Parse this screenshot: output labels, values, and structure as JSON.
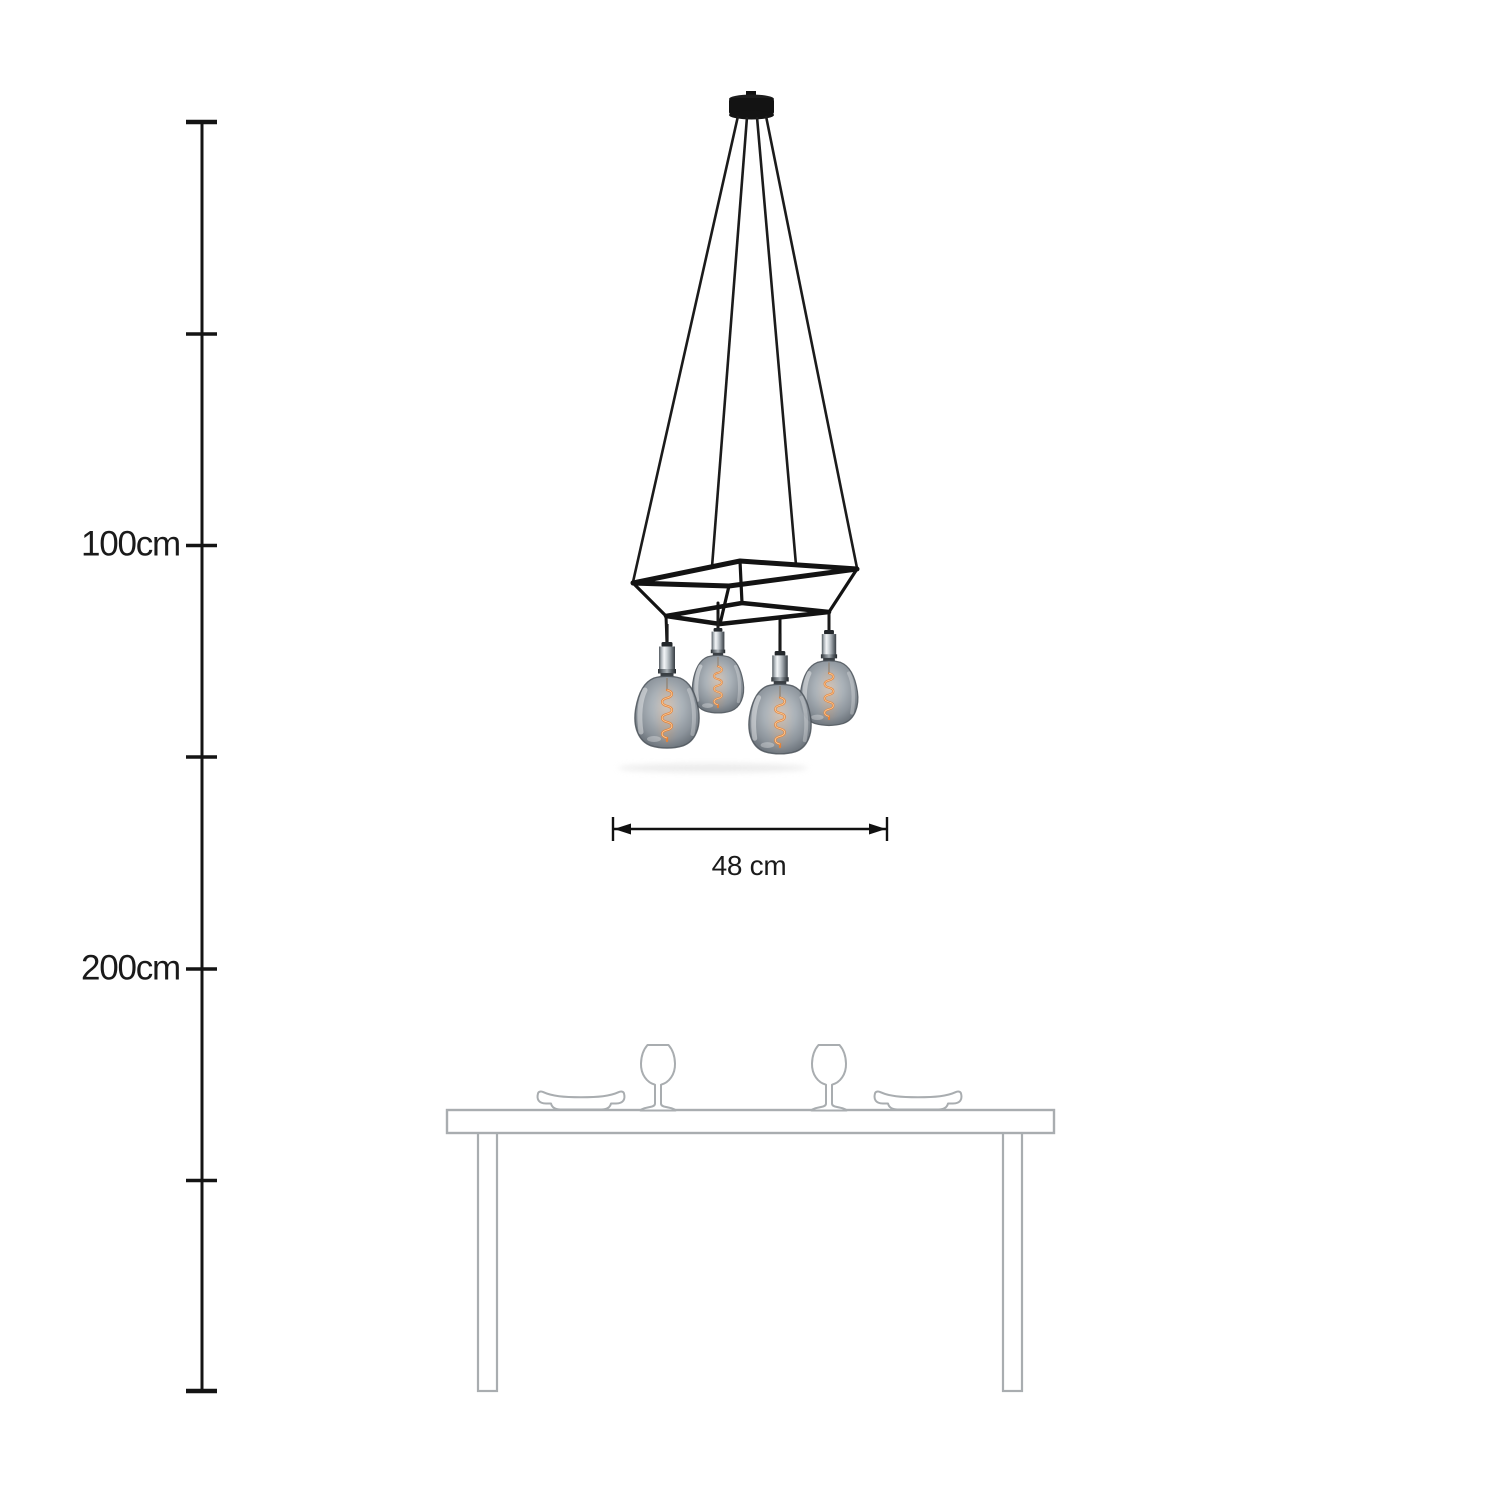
{
  "ruler": {
    "labels": {
      "hundred": "100cm",
      "two_hundred": "200cm"
    }
  },
  "dimension": {
    "width": "48 cm"
  },
  "lamp": {
    "bulb_count": 4,
    "colors": {
      "ceiling_rose": "#131313",
      "cable": "#1b1b1b",
      "cage_frame": "#131313",
      "socket_chrome": "#c9ced2",
      "smoked_glass": "#8f979e",
      "filament": "#ee8a3c"
    }
  },
  "scene": {
    "background": "#ffffff",
    "ink": "#141414",
    "table_outline": "#a9adb0",
    "icons": [
      "ceiling-rose-icon",
      "wine-glass-icon",
      "plate-icon",
      "dining-table"
    ]
  }
}
